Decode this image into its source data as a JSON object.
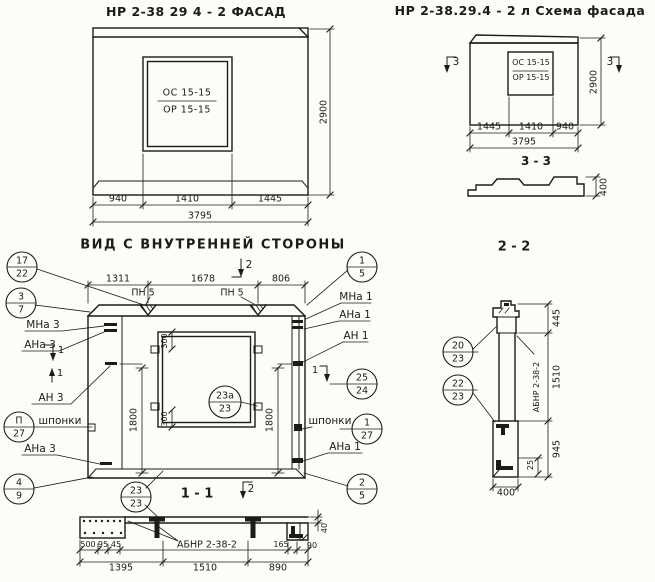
{
  "colors": {
    "ink": "#1b1b1b",
    "paper": "#fcfcf9"
  },
  "facade": {
    "title": "НР 2-38 29 4 - 2  ФАСАД",
    "window_line1": "ОС 15-15",
    "window_line2": "ОР 15-15",
    "dim_940": "940",
    "dim_1410": "1410",
    "dim_1445": "1445",
    "dim_3795": "3795",
    "dim_2900": "2900"
  },
  "scheme": {
    "title": "НР 2-38.29.4 - 2 л  Схема фасада",
    "window_line1": "ОС 15-15",
    "window_line2": "ОР 15-15",
    "mark3": "3",
    "dim_1445": "1445",
    "dim_1410": "1410",
    "dim_940": "940",
    "dim_3795": "3795",
    "dim_2900": "2900",
    "section_label": "3 - 3",
    "dim_400": "400"
  },
  "inner": {
    "title": "ВИД С ВНУТРЕННЕЙ СТОРОНЫ",
    "dim_1311": "1311",
    "dim_1678": "1678",
    "dim_806": "806",
    "dim_1800": "1800",
    "dim_300": "300",
    "loop_label": "ПН 5",
    "marks": {
      "sec1": "1",
      "sec2": "2"
    },
    "labels": {
      "mna3": "МНа 3",
      "ana3": "АНа 3",
      "an3": "АН 3",
      "shponki": "шпонки",
      "mna1": "МНа 1",
      "ana1": "АНа 1",
      "an1": "АН 1"
    },
    "callouts": {
      "c17_22": {
        "top": "17",
        "bottom": "22"
      },
      "c3_7": {
        "top": "3",
        "bottom": "7"
      },
      "cp_27": {
        "top": "П",
        "bottom": "27"
      },
      "c4_9": {
        "top": "4",
        "bottom": "9"
      },
      "c23a_23": {
        "top": "23а",
        "bottom": "23"
      },
      "c1_5": {
        "top": "1",
        "bottom": "5"
      },
      "c25_24": {
        "top": "25",
        "bottom": "24"
      },
      "c1_27": {
        "top": "1",
        "bottom": "27"
      },
      "c2_5": {
        "top": "2",
        "bottom": "5"
      }
    }
  },
  "section_1_1": {
    "title": "1 - 1",
    "mark2": "2",
    "part_label": "АБНР 2-38-2",
    "callout_23_23": {
      "top": "23",
      "bottom": "23"
    },
    "dim_500": "500",
    "dim_95": "95",
    "dim_45": "45",
    "dim_165": "165",
    "dim_90": "90",
    "dim_40": "40",
    "dim_1395": "1395",
    "dim_1510": "1510",
    "dim_890": "890"
  },
  "section_2_2": {
    "title": "2 - 2",
    "part_label": "АБНР 2-38-2",
    "dim_445": "445",
    "dim_1510": "1510",
    "dim_945": "945",
    "dim_25": "25",
    "dim_400": "400",
    "callouts": {
      "c20_23": {
        "top": "20",
        "bottom": "23"
      },
      "c22_23": {
        "top": "22",
        "bottom": "23"
      }
    }
  }
}
